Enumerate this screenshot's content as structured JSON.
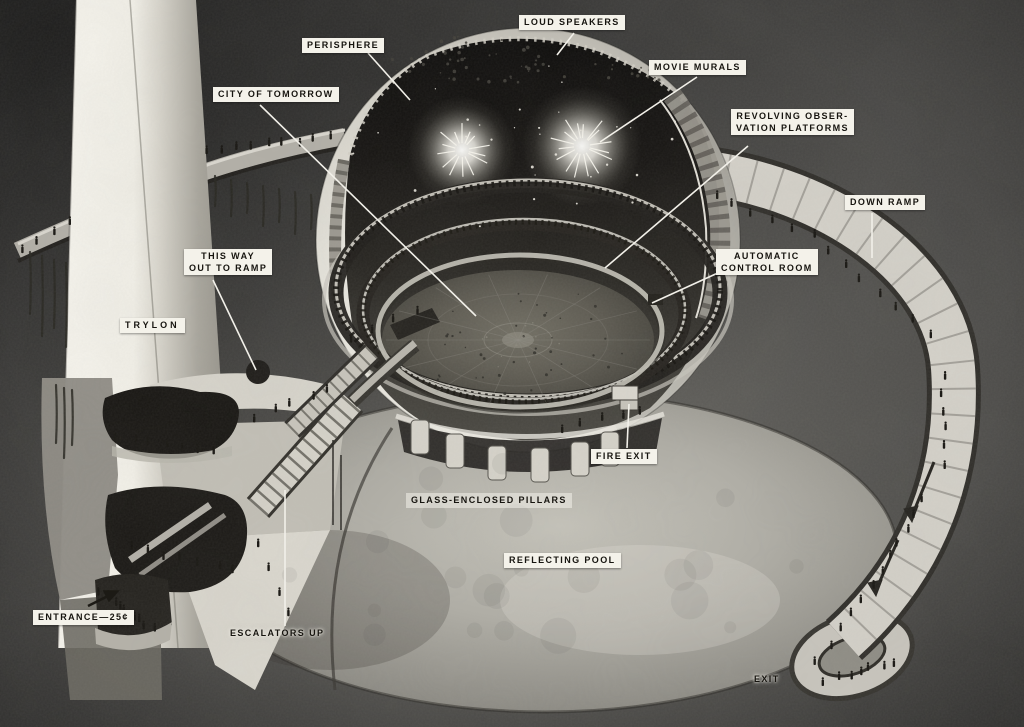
{
  "colors": {
    "background": "#4b4a48",
    "label_background": "#f4f2ea",
    "label_text": "#16140f",
    "leader_line": "#f2f0e9"
  },
  "labels": {
    "loud_speakers": {
      "text": "LOUD SPEAKERS"
    },
    "perisphere": {
      "text": "PERISPHERE"
    },
    "movie_murals": {
      "text": "MOVIE MURALS"
    },
    "city_of_tomorrow": {
      "text": "CITY OF TOMORROW"
    },
    "revolving_platforms": {
      "line1": "REVOLVING OBSER-",
      "line2": "VATION PLATFORMS"
    },
    "down_ramp": {
      "text": "DOWN RAMP"
    },
    "this_way_out": {
      "line1": "THIS WAY",
      "line2": "OUT TO RAMP"
    },
    "automatic_control_room": {
      "line1": "AUTOMATIC",
      "line2": "CONTROL ROOM"
    },
    "trylon": {
      "text": "TRYLON"
    },
    "fire_exit": {
      "text": "FIRE EXIT"
    },
    "glass_enclosed_pillars": {
      "text": "GLASS-ENCLOSED PILLARS"
    },
    "reflecting_pool": {
      "text": "REFLECTING POOL"
    },
    "escalators_up": {
      "text": "ESCALATORS UP"
    },
    "entrance": {
      "text": "ENTRANCE—25¢"
    },
    "exit": {
      "text": "EXIT"
    }
  }
}
